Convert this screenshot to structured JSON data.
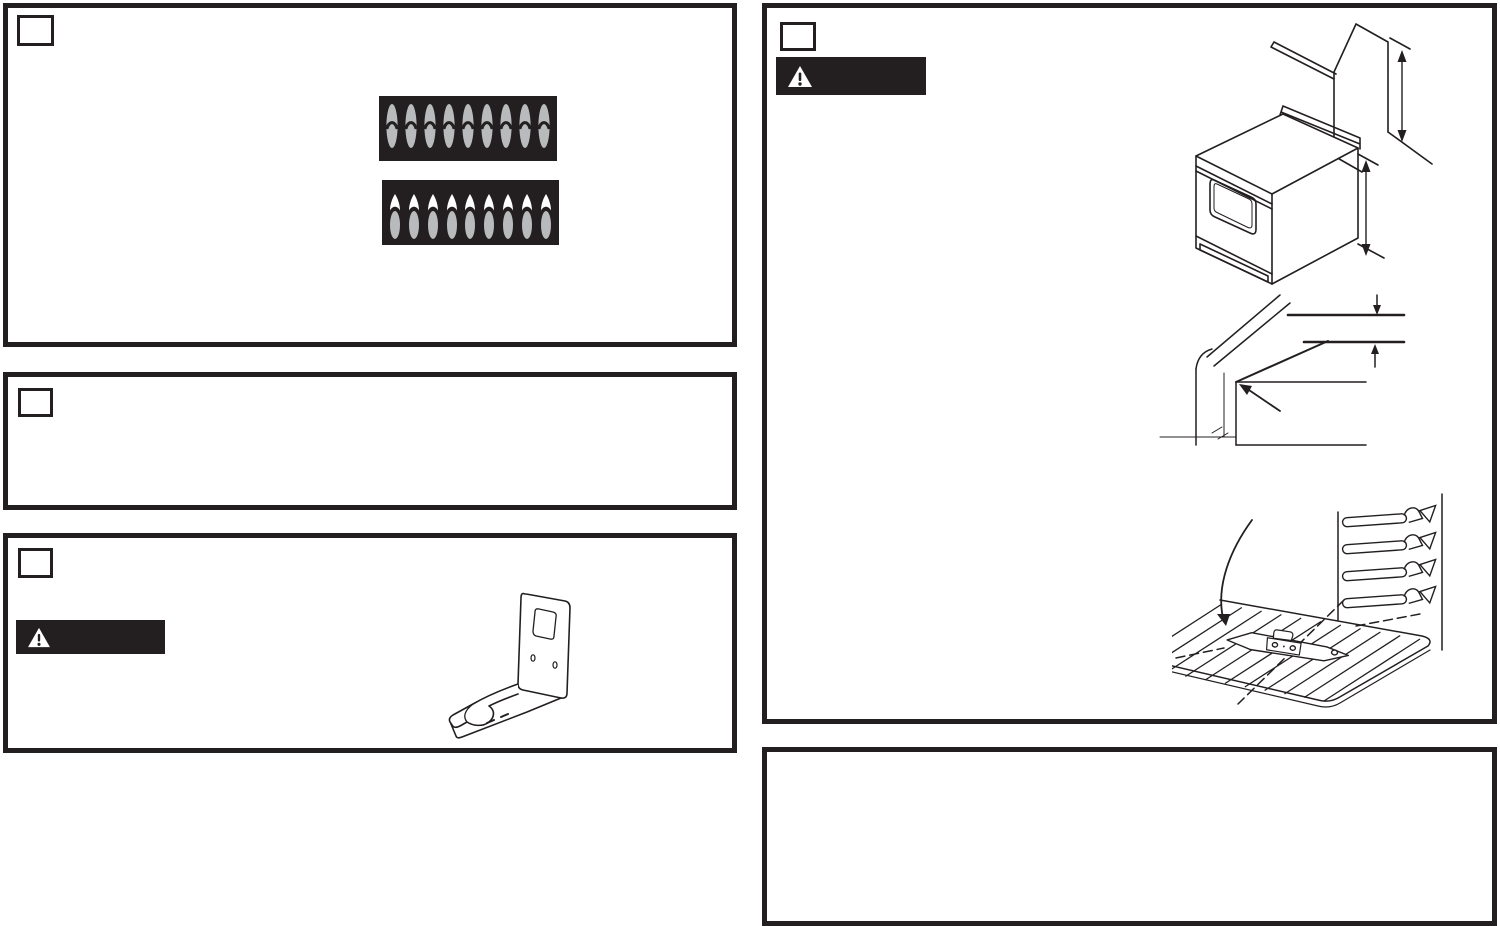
{
  "page": {
    "kind": "appliance-installation-manual-page",
    "background": "#ffffff",
    "ink": "#231f20"
  },
  "flames": {
    "count_per_row": 9,
    "flame_color": "#b9babc",
    "tip_color": "#ffffff",
    "panel_background": "#231f20",
    "rows": [
      {
        "id": "inner-cone",
        "description": "nine burner flames with dark inner-cone arc on black panel"
      },
      {
        "id": "yellow-tips",
        "description": "nine burner flames with white/yellow tips on black panel"
      }
    ]
  },
  "warning": {
    "glyph": "!",
    "bar_color": "#231f20",
    "triangle_color": "#ffffff",
    "instances": 2
  },
  "rack": {
    "wire_count": 11,
    "support_count": 4
  },
  "illustrations": {
    "burner_flames_top": "gas burner flame row - correct flames with inner cones",
    "burner_flames_bottom": "gas burner flame row - flames with yellow tips",
    "anti_tip_bracket": "anti-tip bracket sheet-metal part",
    "range_clearance": "free-standing range beside wall cabinet with two vertical dimension arrows",
    "countertop_corner": "countertop corner edge detail with thickness dimension arrows and pointer arrow",
    "oven_rack": "oven rack with bracket part, dashed centerlines, curved arrow and four embossed rack supports"
  },
  "panels": {
    "top_left": {
      "step_label": ""
    },
    "mid_left": {
      "step_label": ""
    },
    "bottom_left": {
      "step_label": ""
    },
    "top_right": {
      "step_label": ""
    },
    "bottom_right": {}
  }
}
